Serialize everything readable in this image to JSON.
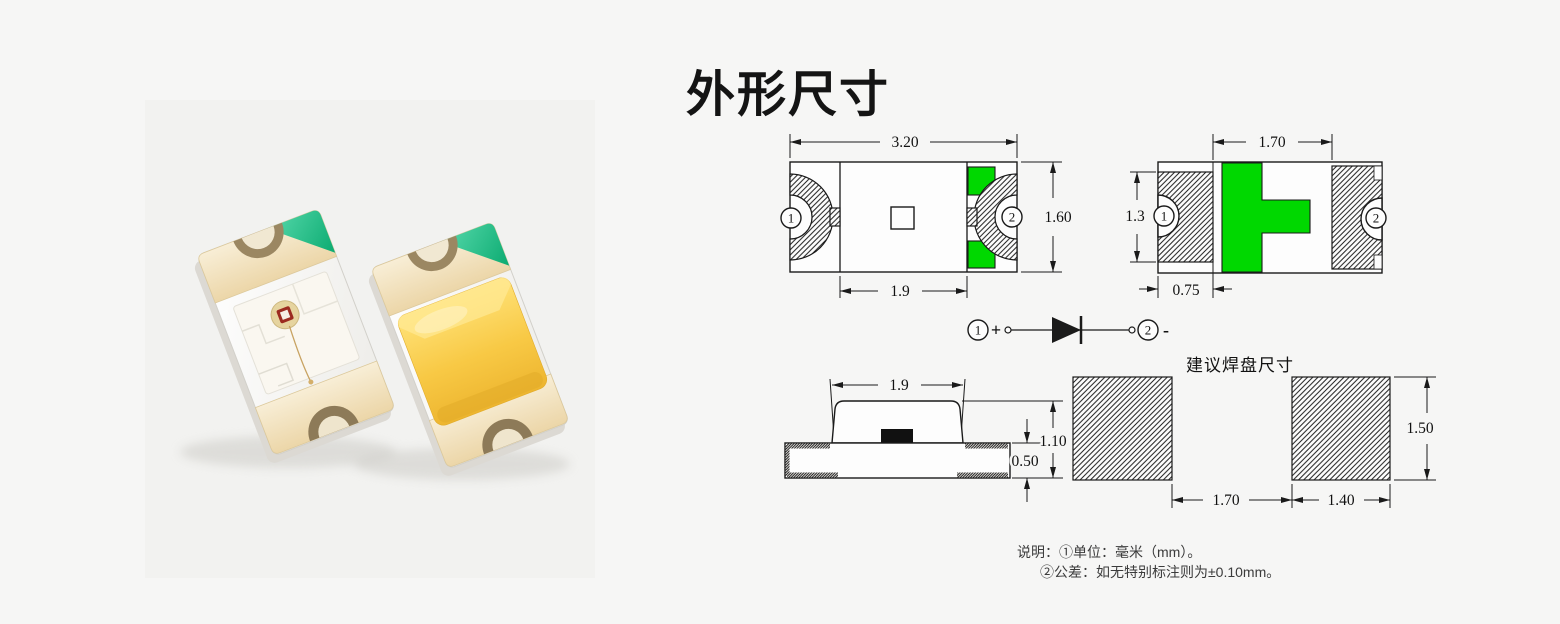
{
  "page": {
    "title": "外形尺寸",
    "background": "#f6f6f5"
  },
  "photo": {
    "subject": "two-smd-led-chips",
    "body_color": "#ffffff",
    "lens_color": "#ffd44d",
    "terminal_color": "#f2e2bd",
    "corner_mark_color": "#2bbf8e"
  },
  "drawings": {
    "line_color": "#1a1a1a",
    "highlight_green": "#00d800",
    "top_view": {
      "dim_width": "3.20",
      "dim_height": "1.60",
      "dim_inner_width": "1.9",
      "pin1": "1",
      "pin2": "2"
    },
    "bottom_view": {
      "dim_gap": "1.70",
      "dim_terminal_height": "1.3",
      "dim_terminal_width": "0.75",
      "pin1": "1",
      "pin2": "2"
    },
    "polarity": {
      "pin1": "1",
      "plus": "+",
      "pin2": "2",
      "minus": "-"
    },
    "side_view": {
      "dim_lens_width": "1.9",
      "dim_total_height": "1.10",
      "dim_base_height": "0.50"
    },
    "pad_layout": {
      "title": "建议焊盘尺寸",
      "dim_pad_height": "1.50",
      "dim_gap": "1.70",
      "dim_pad_width": "1.40"
    },
    "notes": {
      "line1": "说明：①单位：毫米（mm）。",
      "line2": "②公差：如无特别标注则为±0.10mm。"
    }
  }
}
